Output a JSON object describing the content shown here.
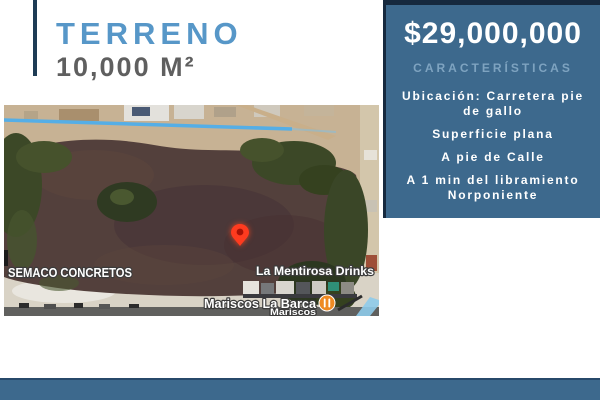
{
  "header": {
    "title": "TERRENO",
    "area": "10,000 M²"
  },
  "panel": {
    "price": "$29,000,000",
    "section_title": "CARACTERÍSTICAS",
    "features": [
      "Ubicación: Carretera pie de gallo",
      "Superficie plana",
      "A pie de Calle",
      "A 1 min del libramiento Norponiente"
    ]
  },
  "map": {
    "labels": {
      "semaco": "SEMACO CONCRETOS",
      "mentirosa": "La Mentirosa Drinks",
      "barca": "Mariscos La Barca",
      "barca_sub": "Mariscos"
    },
    "marker": "red-location-pin",
    "poi_icon": "restaurant-icon"
  },
  "colors": {
    "accent_blue": "#5797c8",
    "dark_navy": "#1e3c55",
    "panel_blue": "#3d698d",
    "panel_border": "#16293e",
    "section_title_blue": "#7ea3c0",
    "text_gray": "#5f5f5f",
    "pin_red": "#fe3b1f",
    "route_blue": "#55aee6",
    "restaurant_orange": "#ee8a23"
  }
}
